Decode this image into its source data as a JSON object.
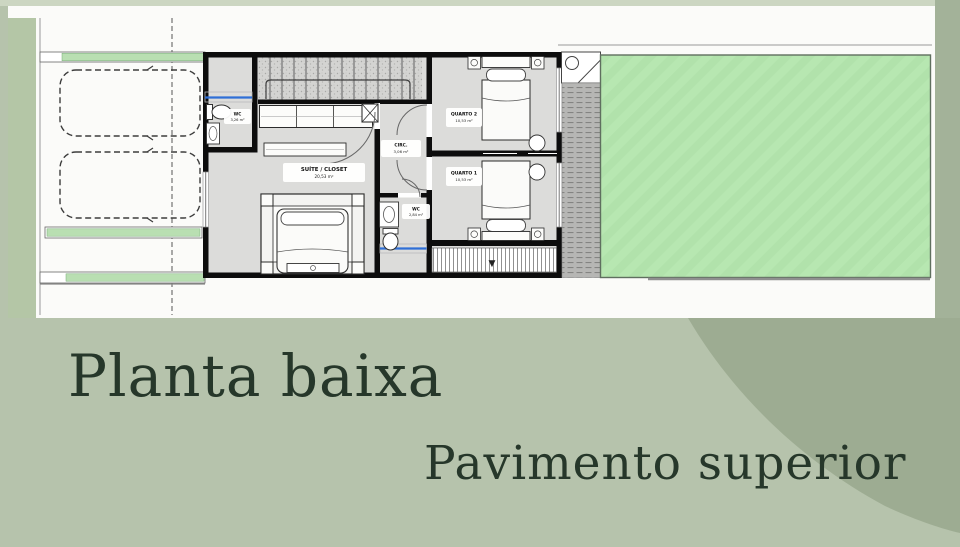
{
  "captions": {
    "title": "Planta baixa",
    "subtitle": "Pavimento superior"
  },
  "plan": {
    "rooms": {
      "wc1": {
        "name": "WC",
        "area": "3,26 m²"
      },
      "suite": {
        "name": "SUÍTE / CLOSET",
        "area": "20,53 m²"
      },
      "circ": {
        "name": "CIRC.",
        "area": "3,06 m²"
      },
      "wc2": {
        "name": "WC",
        "area": "2,84 m²"
      },
      "quarto2": {
        "name": "QUARTO 2",
        "area": "10,53 m²"
      },
      "quarto1": {
        "name": "QUARTO 1",
        "area": "10,53 m²"
      }
    }
  },
  "icons": {
    "down_arrow": "▼"
  },
  "colors": {
    "background_sage": "#b6c3ac",
    "band_left": "#b4c6a6",
    "band_right": "#a3b299",
    "blob_dark_sage": "#9dac92",
    "top_strip": "#ccd6c2",
    "sheet_white": "#fbfbf9",
    "lawn_green": "#b7e7b1",
    "planter_green": "#b9dfb2",
    "window_accent_blue": "#2f6fd6",
    "title_text": "#26372a"
  }
}
